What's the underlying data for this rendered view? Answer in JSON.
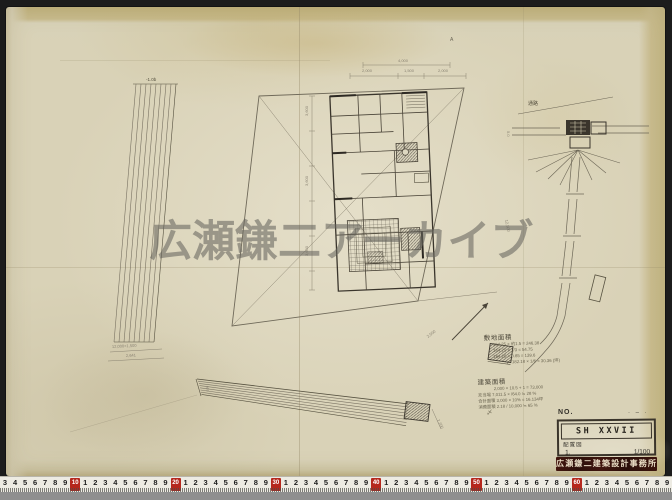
{
  "watermark": {
    "text": "広瀬鎌二アーカイブ"
  },
  "colors": {
    "paper": "#d9d2b7",
    "pencil": "#6d6757",
    "pencil_dark": "#35312a",
    "ruler_red": "#b5271d",
    "stamp_bg": "#33120d"
  },
  "plan": {
    "apex_mark": "A",
    "top_dim_total": "4,000",
    "top_dim_1": "2,000",
    "top_dim_2": "1,500",
    "top_dim_3": "2,000",
    "left_dim_1": "3,600",
    "left_dim_2": "3,600",
    "left_dim_3": "3,600",
    "slope_dim": "2,500",
    "side_dim": "12,500"
  },
  "left_strip": {
    "top_label": "-1.0b",
    "dim_1": "12,000×1,500",
    "dim_2": "2,641"
  },
  "bottom_strip": {
    "left_dim": "900",
    "end_dim": "1,200"
  },
  "road_detail": {
    "label": "通路",
    "width_dim": "5.0"
  },
  "notes": {
    "block1_title": "敷地面積",
    "block1_lines": [
      "164.25 × 約1.5 = 246.38",
      "164.25 × 1/3 = 54.75",
      "164.25 × 0.85 = 139.6",
      "〆 182.18 × 1/6 = 30.36 (坪)"
    ],
    "block2_title": "建築面積",
    "block2_lines": [
      "2,000 × 10.5 + 1 = 73,000",
      "充当場 7,011.5 × /64.0 ≒ 28 %",
      "合計面積 3,000 × 10% = 16.134坪",
      "消費面積 2.18 / 10,000 ≒ 65 %",
      "〆"
    ]
  },
  "title_block": {
    "no_label": "NO.",
    "top_marks": "· – ·",
    "code": "SH XXVII",
    "drawing_name": "配置図",
    "sheet_no": "1.",
    "scale": "1/100",
    "stamp": "広瀬鎌二建築設計事務所"
  },
  "ruler": {
    "lead_digits": [
      3,
      4,
      5,
      6,
      7,
      8,
      9
    ],
    "decades": [
      10,
      20,
      30,
      40,
      50,
      60
    ],
    "unit_digits": [
      1,
      2,
      3,
      4,
      5,
      6,
      7,
      8,
      9
    ]
  }
}
